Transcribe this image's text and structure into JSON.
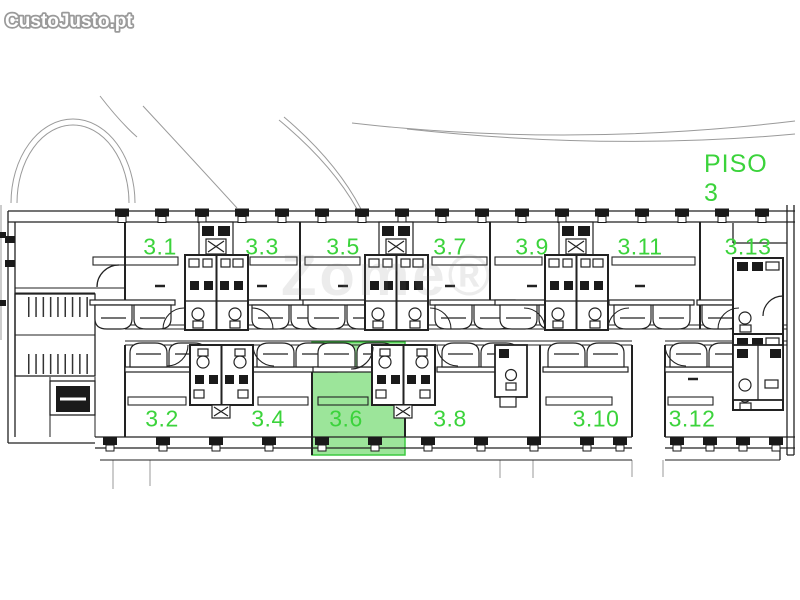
{
  "brand": {
    "logo_text": "CustoJusto.pt"
  },
  "floor_plan": {
    "title": "PISO 3",
    "watermark": "Zome®",
    "highlighted_room": "3.6",
    "rooms_top": [
      "3.1",
      "3.3",
      "3.5",
      "3.7",
      "3.9",
      "3.11",
      "3.13"
    ],
    "rooms_bottom": [
      "3.2",
      "3.4",
      "3.6",
      "3.8",
      "3.10",
      "3.12"
    ],
    "colors": {
      "room_label": "#3bd33b",
      "highlight_fill": "#9ce59a",
      "highlight_stroke": "#3cc940",
      "linework": "#222222",
      "logo_fill": "#ffffff",
      "logo_outline": "#9a9a9a"
    }
  }
}
